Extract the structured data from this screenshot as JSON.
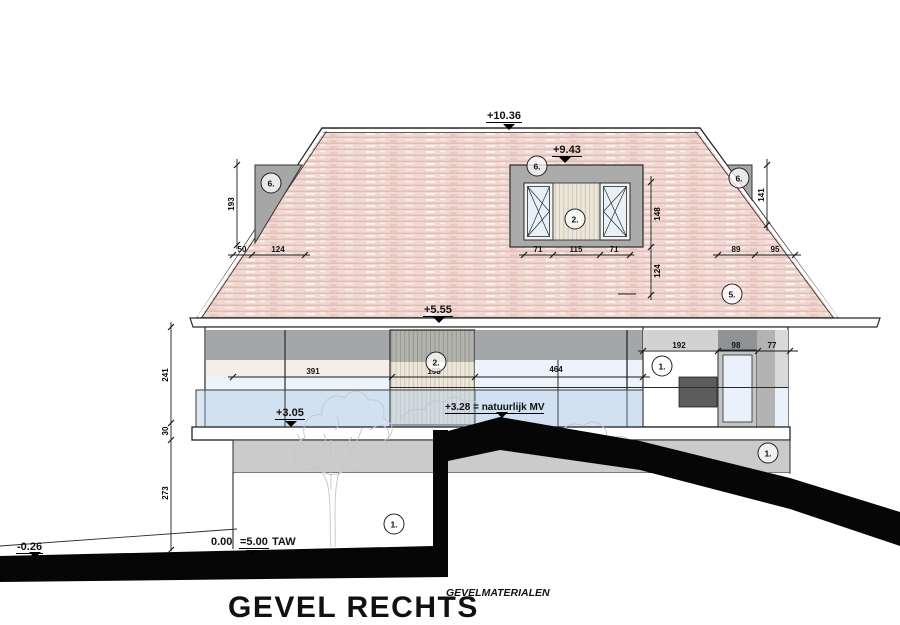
{
  "drawing": {
    "title": "GEVEL RECHTS",
    "legend_title": "GEVELMATERIALEN",
    "levels": {
      "ridge": "+10.36",
      "dormer": "+9.43",
      "eaves": "+5.55",
      "balcony": "+3.05",
      "natural_ground": "+3.28 = natuurlijk MV",
      "zero": "0.00",
      "zero_datum": "=5.00",
      "datum_unit": "TAW",
      "terrain_left": "-0.26"
    },
    "dims": {
      "roof_left_h": "193",
      "roof_right_h": "141",
      "roof_left_w1": "50",
      "roof_left_w2": "124",
      "roof_right_w1": "89",
      "roof_right_w2": "95",
      "dormer_w1": "71",
      "dormer_w2": "115",
      "dormer_w3": "71",
      "dormer_h1": "148",
      "dormer_h2": "124",
      "wall_chain_1": "241",
      "wall_chain_2": "30",
      "wall_chain_3": "273",
      "facade_w1": "391",
      "facade_w2": "198",
      "facade_w3": "464",
      "right_w1": "192",
      "right_w2": "98",
      "right_w3": "77"
    },
    "material_refs": {
      "roof_left": "6.",
      "dormer_top": "6.",
      "dormer_panel": "2.",
      "roof_right": "6.",
      "roof_tiles": "5.",
      "facade_panel": "2.",
      "wall_right": "1.",
      "plinth": "1.",
      "wall_lower": "1."
    }
  }
}
